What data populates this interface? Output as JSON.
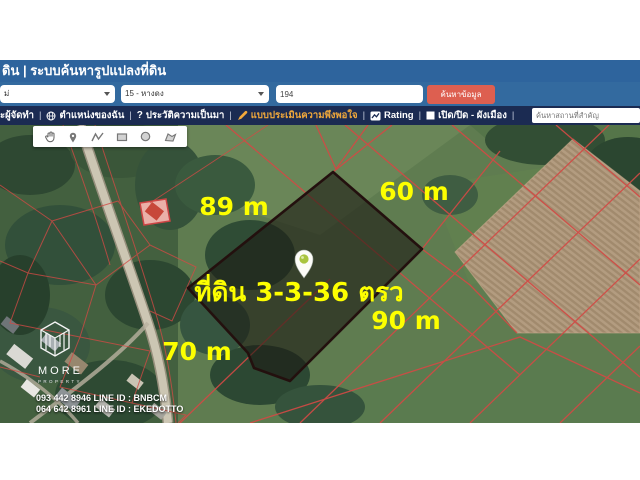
{
  "header": {
    "title": "ดิน | ระบบค้นหารูปแปลงที่ดิน"
  },
  "controls": {
    "area_select": {
      "value": "ม่"
    },
    "district_select": {
      "value": "15 - หางดง"
    },
    "parcel_input": {
      "value": "194"
    },
    "search_button": {
      "label": "ค้นหาข้อมูล"
    }
  },
  "menubar": {
    "separator": "|",
    "item_creators": {
      "label": "ะผู้จัดทำ"
    },
    "item_my_location": {
      "label": "ตำแหน่งของฉัน",
      "icon": "globe-icon"
    },
    "item_history": {
      "label": "ประวัติความเป็นมา",
      "icon": "question-icon"
    },
    "item_survey": {
      "label": "แบบประเมินความพึงพอใจ",
      "icon": "pencil-icon",
      "color": "#f2a93b"
    },
    "item_rating": {
      "label": "Rating",
      "icon": "chart-icon"
    },
    "item_city_plan": {
      "label": "เปิด/ปิด - ผังเมือง",
      "icon": "square-icon"
    },
    "search_placeholder": "ค้นหาสถานที่สำคัญ"
  },
  "map": {
    "toolbar_icons": [
      "hand-icon",
      "marker-icon",
      "polyline-icon",
      "rectangle-icon",
      "circle-icon",
      "polygon-icon"
    ],
    "parcel": {
      "label": "ที่ดิน 3-3-36 ตรว",
      "side_top_left": "89 m",
      "side_top_right": "60 m",
      "side_bottom_right": "90 m",
      "side_bottom_left": "70 m"
    }
  },
  "branding": {
    "logo": "MORE",
    "logo_sub": "PROPERTY",
    "contact_line1": "093 442 8946 LINE ID : BNBCM",
    "contact_line2": "064 642 8961  LINE ID : EKEDOTTO"
  },
  "colors": {
    "header_blue": "#2e649d",
    "menubar_navy": "#1b2b52",
    "button_red": "#dd5f50",
    "highlight_orange": "#f2a93b",
    "label_yellow": "#fdff00",
    "cadastral_red": "#d24a45"
  }
}
